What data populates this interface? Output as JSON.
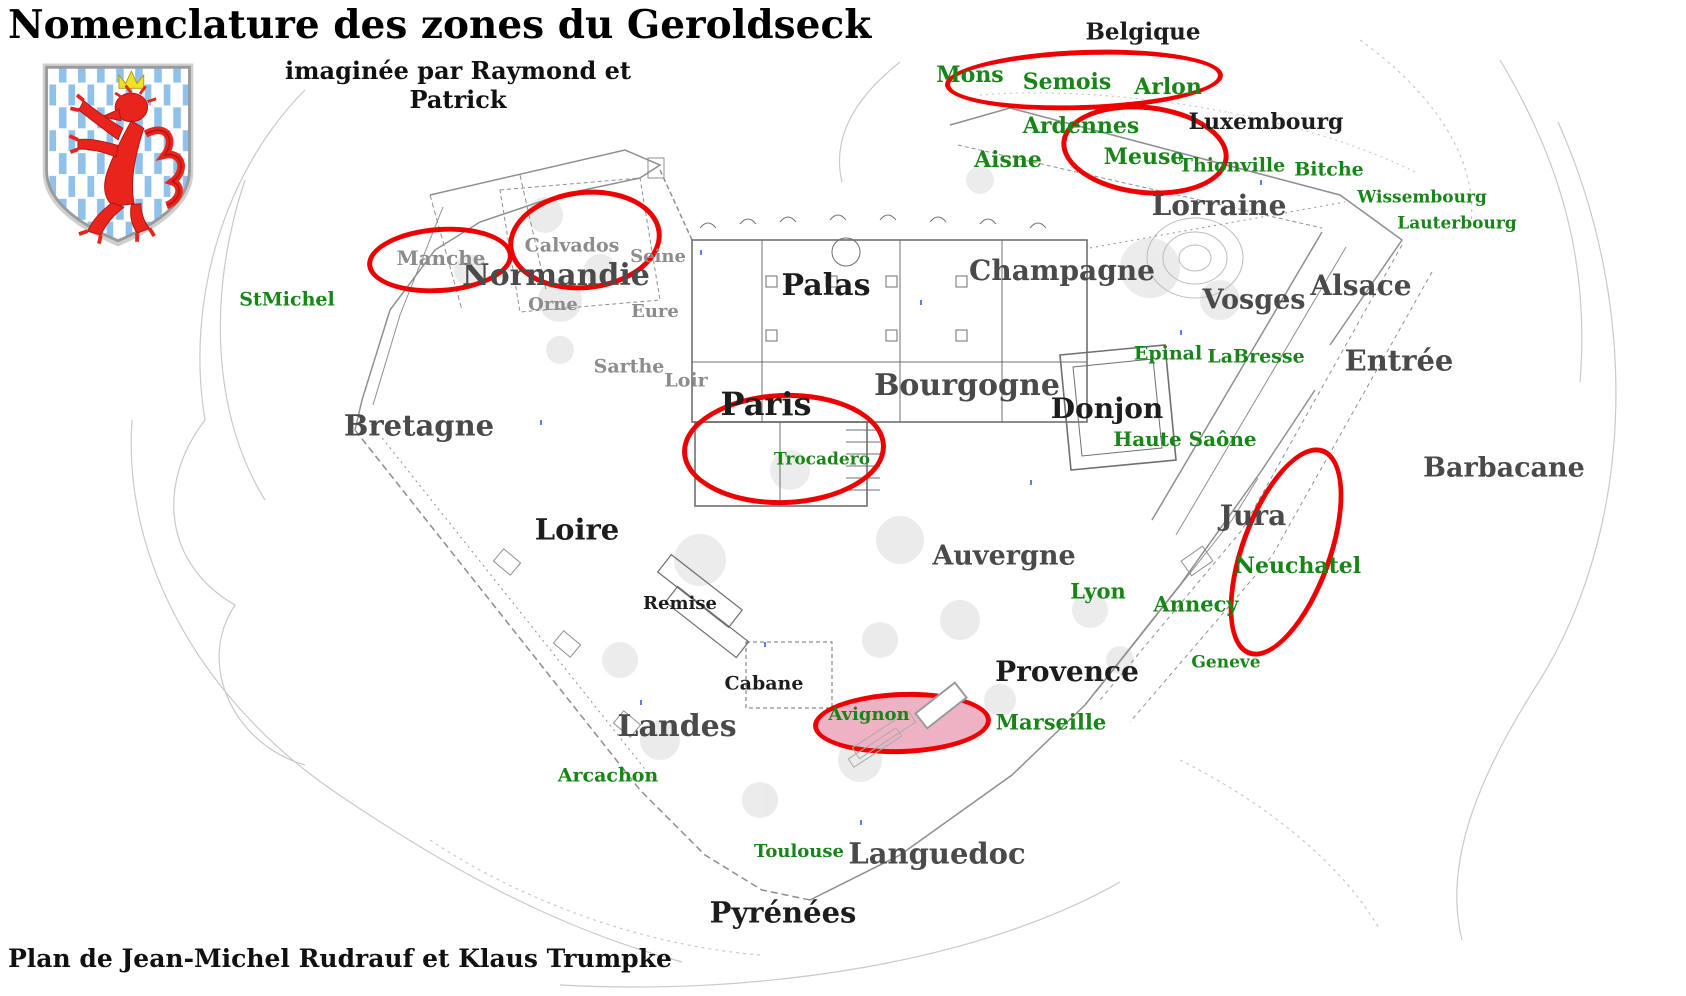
{
  "header": {
    "title": "Nomenclature des zones du Geroldseck",
    "subtitle": "imaginée par Raymond et Patrick"
  },
  "footer": {
    "credit": "Plan de Jean-Michel Rudrauf et Klaus Trumpke"
  },
  "coat_of_arms": {
    "name": "luxembourg-lion-shield",
    "colors": {
      "field": "#ffffff",
      "billets": "#8fc1ea",
      "lion": "#e8241c",
      "crown": "#f2e227",
      "border": "#9a9a9a"
    }
  },
  "colors": {
    "zone_label_dark": "#1d1d1d",
    "zone_label_gray": "#4a4a4a",
    "room_label": "#8c8c8c",
    "place_label": "#178517",
    "highlight_stroke": "#ee0000",
    "highlight_fill": "#efb2c5",
    "plan_line": "#8f8f8f",
    "terrain_line": "#c8c8c8"
  },
  "labels": [
    {
      "text": "Belgique",
      "kind": "zone-dark",
      "x": 1143,
      "y": 32,
      "size": 23
    },
    {
      "text": "Luxembourg",
      "kind": "zone-dark",
      "x": 1266,
      "y": 122,
      "size": 22
    },
    {
      "text": "Lorraine",
      "kind": "zone-mid",
      "x": 1219,
      "y": 206,
      "size": 28
    },
    {
      "text": "Alsace",
      "kind": "zone-mid",
      "x": 1361,
      "y": 286,
      "size": 28
    },
    {
      "text": "Vosges",
      "kind": "zone-mid",
      "x": 1254,
      "y": 300,
      "size": 27
    },
    {
      "text": "Entrée",
      "kind": "zone-mid",
      "x": 1399,
      "y": 361,
      "size": 29
    },
    {
      "text": "Barbacane",
      "kind": "zone-mid",
      "x": 1504,
      "y": 468,
      "size": 27
    },
    {
      "text": "Champagne",
      "kind": "zone-mid",
      "x": 1062,
      "y": 271,
      "size": 28
    },
    {
      "text": "Palas",
      "kind": "zone-dark",
      "x": 826,
      "y": 286,
      "size": 30
    },
    {
      "text": "Normandie",
      "kind": "zone-mid",
      "x": 556,
      "y": 276,
      "size": 30
    },
    {
      "text": "Bretagne",
      "kind": "zone-mid",
      "x": 419,
      "y": 426,
      "size": 29
    },
    {
      "text": "Paris",
      "kind": "zone-dark",
      "x": 766,
      "y": 404,
      "size": 32
    },
    {
      "text": "Bourgogne",
      "kind": "zone-mid",
      "x": 967,
      "y": 386,
      "size": 30
    },
    {
      "text": "Donjon",
      "kind": "zone-dark",
      "x": 1107,
      "y": 409,
      "size": 28
    },
    {
      "text": "Jura",
      "kind": "zone-mid",
      "x": 1253,
      "y": 516,
      "size": 28
    },
    {
      "text": "Loire",
      "kind": "zone-dark",
      "x": 577,
      "y": 530,
      "size": 29
    },
    {
      "text": "Auvergne",
      "kind": "zone-mid",
      "x": 1004,
      "y": 556,
      "size": 27
    },
    {
      "text": "Provence",
      "kind": "zone-dark",
      "x": 1067,
      "y": 672,
      "size": 28
    },
    {
      "text": "Remise",
      "kind": "zone-dark",
      "x": 680,
      "y": 604,
      "size": 18
    },
    {
      "text": "Cabane",
      "kind": "zone-dark",
      "x": 764,
      "y": 684,
      "size": 19
    },
    {
      "text": "Landes",
      "kind": "zone-mid",
      "x": 677,
      "y": 727,
      "size": 30
    },
    {
      "text": "Languedoc",
      "kind": "zone-mid",
      "x": 937,
      "y": 854,
      "size": 29
    },
    {
      "text": "Pyrénées",
      "kind": "zone-dark",
      "x": 783,
      "y": 913,
      "size": 29
    },
    {
      "text": "Manche",
      "kind": "room",
      "x": 441,
      "y": 258,
      "size": 20
    },
    {
      "text": "Calvados",
      "kind": "room",
      "x": 572,
      "y": 246,
      "size": 19
    },
    {
      "text": "Seine",
      "kind": "room",
      "x": 658,
      "y": 257,
      "size": 18
    },
    {
      "text": "Orne",
      "kind": "room",
      "x": 553,
      "y": 305,
      "size": 18
    },
    {
      "text": "Eure",
      "kind": "room",
      "x": 655,
      "y": 312,
      "size": 18
    },
    {
      "text": "Sarthe",
      "kind": "room",
      "x": 629,
      "y": 367,
      "size": 19
    },
    {
      "text": "Loir",
      "kind": "room",
      "x": 686,
      "y": 381,
      "size": 19
    },
    {
      "text": "Mons",
      "kind": "place",
      "x": 970,
      "y": 75,
      "size": 22
    },
    {
      "text": "Semois",
      "kind": "place",
      "x": 1067,
      "y": 82,
      "size": 22
    },
    {
      "text": "Arlon",
      "kind": "place",
      "x": 1168,
      "y": 87,
      "size": 22
    },
    {
      "text": "Ardennes",
      "kind": "place",
      "x": 1081,
      "y": 126,
      "size": 22
    },
    {
      "text": "Aisne",
      "kind": "place",
      "x": 1008,
      "y": 160,
      "size": 22
    },
    {
      "text": "Meuse",
      "kind": "place",
      "x": 1144,
      "y": 157,
      "size": 22
    },
    {
      "text": "Thionville",
      "kind": "place",
      "x": 1232,
      "y": 166,
      "size": 19
    },
    {
      "text": "Bitche",
      "kind": "place",
      "x": 1329,
      "y": 170,
      "size": 19
    },
    {
      "text": "Wissembourg",
      "kind": "place",
      "x": 1422,
      "y": 198,
      "size": 17
    },
    {
      "text": "Lauterbourg",
      "kind": "place",
      "x": 1457,
      "y": 224,
      "size": 17
    },
    {
      "text": "Epinal",
      "kind": "place",
      "x": 1168,
      "y": 354,
      "size": 19
    },
    {
      "text": "LaBresse",
      "kind": "place",
      "x": 1256,
      "y": 357,
      "size": 19
    },
    {
      "text": "Haute Saône",
      "kind": "place",
      "x": 1185,
      "y": 439,
      "size": 20
    },
    {
      "text": "StMichel",
      "kind": "place",
      "x": 287,
      "y": 300,
      "size": 19
    },
    {
      "text": "Trocadero",
      "kind": "place",
      "x": 822,
      "y": 460,
      "size": 17
    },
    {
      "text": "Lyon",
      "kind": "place",
      "x": 1098,
      "y": 591,
      "size": 21
    },
    {
      "text": "Annecy",
      "kind": "place",
      "x": 1196,
      "y": 604,
      "size": 21
    },
    {
      "text": "Neuchatel",
      "kind": "place",
      "x": 1298,
      "y": 566,
      "size": 22
    },
    {
      "text": "Geneve",
      "kind": "place",
      "x": 1226,
      "y": 663,
      "size": 17
    },
    {
      "text": "Avignon",
      "kind": "place",
      "x": 869,
      "y": 715,
      "size": 18
    },
    {
      "text": "Marseille",
      "kind": "place",
      "x": 1051,
      "y": 722,
      "size": 21
    },
    {
      "text": "Arcachon",
      "kind": "place",
      "x": 608,
      "y": 776,
      "size": 19
    },
    {
      "text": "Toulouse",
      "kind": "place",
      "x": 799,
      "y": 852,
      "size": 18
    }
  ],
  "highlights": [
    {
      "name": "mons-semois-arlon",
      "cx": 1084,
      "cy": 80,
      "rx": 139,
      "ry": 30,
      "rotate": -2,
      "filled": false
    },
    {
      "name": "ardennes-meuse",
      "cx": 1145,
      "cy": 150,
      "rx": 84,
      "ry": 45,
      "rotate": 6,
      "filled": false
    },
    {
      "name": "calvados",
      "cx": 585,
      "cy": 240,
      "rx": 77,
      "ry": 50,
      "rotate": -6,
      "filled": false
    },
    {
      "name": "manche",
      "cx": 440,
      "cy": 260,
      "rx": 73,
      "ry": 33,
      "rotate": -4,
      "filled": false
    },
    {
      "name": "paris-trocadero",
      "cx": 784,
      "cy": 449,
      "rx": 102,
      "ry": 56,
      "rotate": -2,
      "filled": false
    },
    {
      "name": "neuchatel",
      "cx": 1286,
      "cy": 552,
      "rx": 46,
      "ry": 110,
      "rotate": 20,
      "filled": false
    },
    {
      "name": "avignon",
      "cx": 902,
      "cy": 723,
      "rx": 89,
      "ry": 31,
      "rotate": -2,
      "filled": true
    }
  ]
}
